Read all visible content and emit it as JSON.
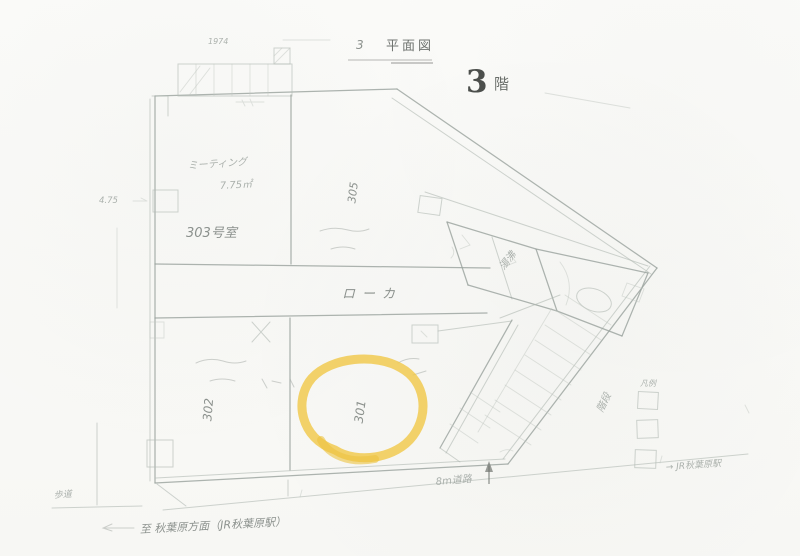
{
  "header": {
    "section_number": "3",
    "title": "平面図",
    "floor_number": "3",
    "floor_suffix": "階"
  },
  "rooms": {
    "room_303": "303号室",
    "room_305": "305",
    "room_302": "302",
    "room_301": "301",
    "corridor": "ローカ"
  },
  "annotations": {
    "meeting_line1": "ミーティング",
    "meeting_line2": "7.75㎡",
    "pantry": "湯沸",
    "stairs": "階段",
    "legend_title": "凡例",
    "dim_left": "4.75",
    "dim_top": "1974",
    "sidewalk": "歩道",
    "road": "8m道路",
    "station_left": "至 秋葉原方面（JR秋葉原駅）",
    "station_right": "→ JR秋葉原駅"
  },
  "highlight": {
    "target_room": "301",
    "color": "#F0C84B"
  }
}
